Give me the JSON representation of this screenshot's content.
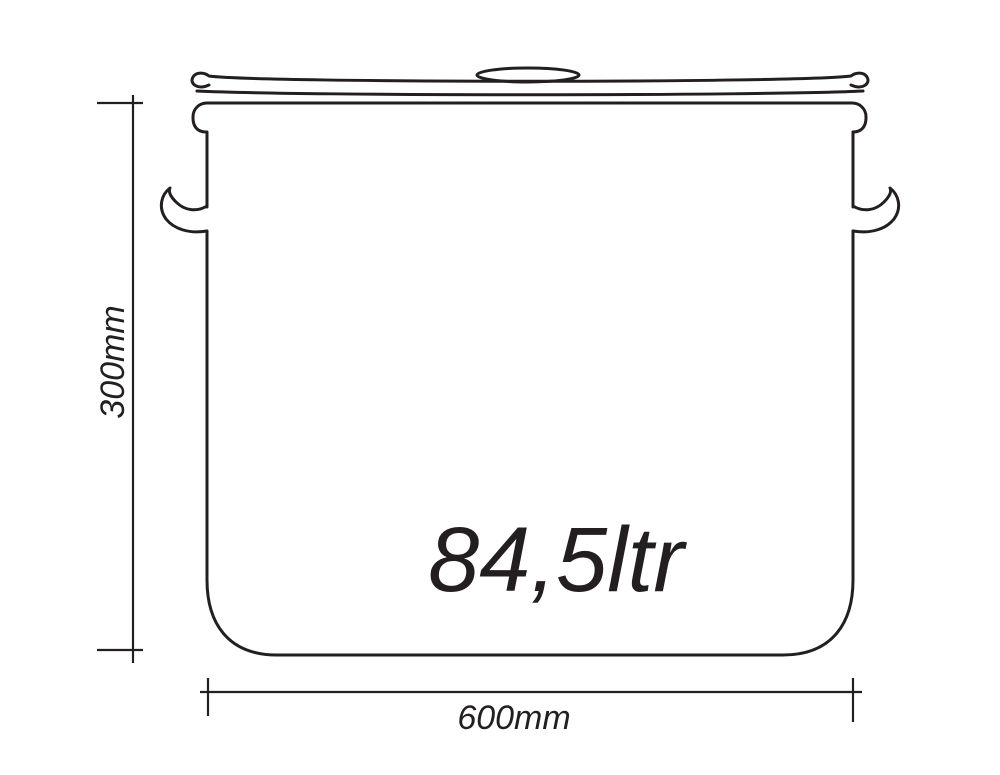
{
  "page": {
    "background": "#ffffff"
  },
  "drawing": {
    "subject": "stock-pot-with-lid-side-view",
    "line_color": "#231f20",
    "capacity_label": "84,5ltr",
    "height_dimension_label": "300mm",
    "width_dimension_label": "600mm"
  }
}
